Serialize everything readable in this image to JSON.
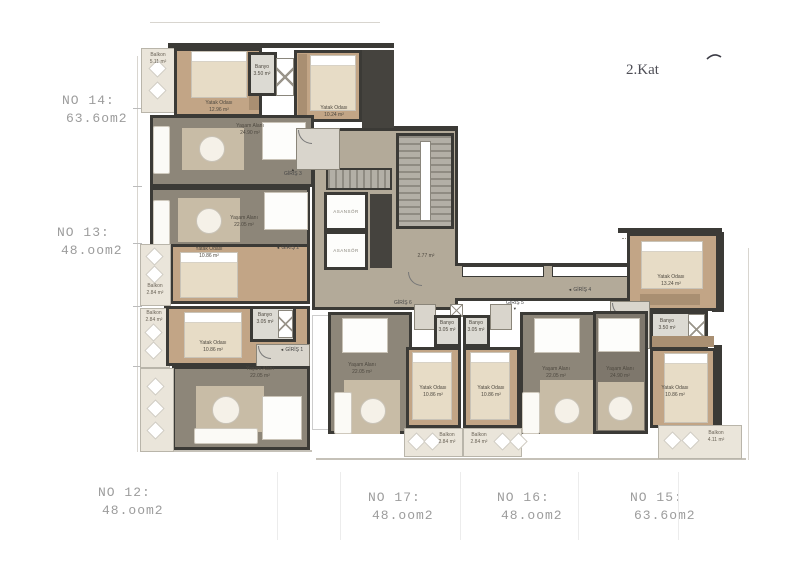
{
  "floor_label": "2.Kat",
  "units": {
    "no14": {
      "name": "NO 14:",
      "area": "63.6om2"
    },
    "no13": {
      "name": "NO 13:",
      "area": "48.oom2"
    },
    "no12": {
      "name": "NO 12:",
      "area": "48.oom2"
    },
    "no17": {
      "name": "NO 17:",
      "area": "48.oom2"
    },
    "no16": {
      "name": "NO 16:",
      "area": "48.oom2"
    },
    "no15": {
      "name": "NO 15:",
      "area": "63.6om2"
    }
  },
  "rooms": {
    "r14_balcony": {
      "label": "Balkon",
      "area": "5.11 m²"
    },
    "r14_bed1": {
      "label": "Yatak Odası",
      "area": "12.96 m²"
    },
    "r14_banyo": {
      "label": "Banyo",
      "area": "3.50 m²"
    },
    "r14_bed2": {
      "label": "Yatak Odası",
      "area": "10.24 m²"
    },
    "r14_living": {
      "label": "Yaşam Alanı",
      "area": "24.90 m²"
    },
    "r13_living": {
      "label": "Yaşam Alanı",
      "area": "22.05 m²"
    },
    "r13_bed": {
      "label": "Yatak Odası",
      "area": "10.86 m²"
    },
    "r13_balcony": {
      "label": "Balkon",
      "area": "2.84 m²"
    },
    "r12_balcony": {
      "label": "Balkon",
      "area": "2.84 m²"
    },
    "r12_bed": {
      "label": "Yatak Odası",
      "area": "10.86 m²"
    },
    "r12_banyo": {
      "label": "Banyo",
      "area": "3.05 m²"
    },
    "r12_living": {
      "label": "Yaşam Alanı",
      "area": "22.05 m²"
    },
    "r17_living": {
      "label": "Yaşam Alanı",
      "area": "22.05 m²"
    },
    "r17_bed": {
      "label": "Yatak Odası",
      "area": "10.86 m²"
    },
    "r17_banyo": {
      "label": "Banyo",
      "area": "3.05 m²"
    },
    "r17_balcony": {
      "label": "Balkon",
      "area": "2.84 m²"
    },
    "r16_living": {
      "label": "Yaşam Alanı",
      "area": "22.05 m²"
    },
    "r16_bed": {
      "label": "Yatak Odası",
      "area": "10.86 m²"
    },
    "r16_banyo": {
      "label": "Banyo",
      "area": "3.05 m²"
    },
    "r16_balcony": {
      "label": "Balkon",
      "area": "2.84 m²"
    },
    "r15_living": {
      "label": "Yaşam Alanı",
      "area": "24.90 m²"
    },
    "r15_bed1": {
      "label": "Yatak Odası",
      "area": "13.24 m²"
    },
    "r15_banyo": {
      "label": "Banyo",
      "area": "3.50 m²"
    },
    "r15_bed2": {
      "label": "Yatak Odası",
      "area": "10.86 m²"
    },
    "r15_balcony": {
      "label": "Balkon",
      "area": "4.11 m²"
    }
  },
  "core": {
    "elevator_label": "ASANSÖR",
    "lobby_area": "2.77 m²"
  },
  "entrances": {
    "g1": "GİRİŞ 1",
    "g2": "GİRİŞ 2",
    "g3": "GİRİŞ 3",
    "g4": "GİRİŞ 4",
    "g5": "GİRİŞ 5",
    "g6": "GİRİŞ 6"
  },
  "colors": {
    "wall": "#3b3a36",
    "living_floor": "#8d8679",
    "bedroom_floor": "#c2a586",
    "balcony_floor": "#eae5da",
    "core_floor": "#b3aa99",
    "bath_floor": "#dcdad3",
    "unit_label_text": "#9c9c9c",
    "floor_label_text": "#4d4d55"
  }
}
